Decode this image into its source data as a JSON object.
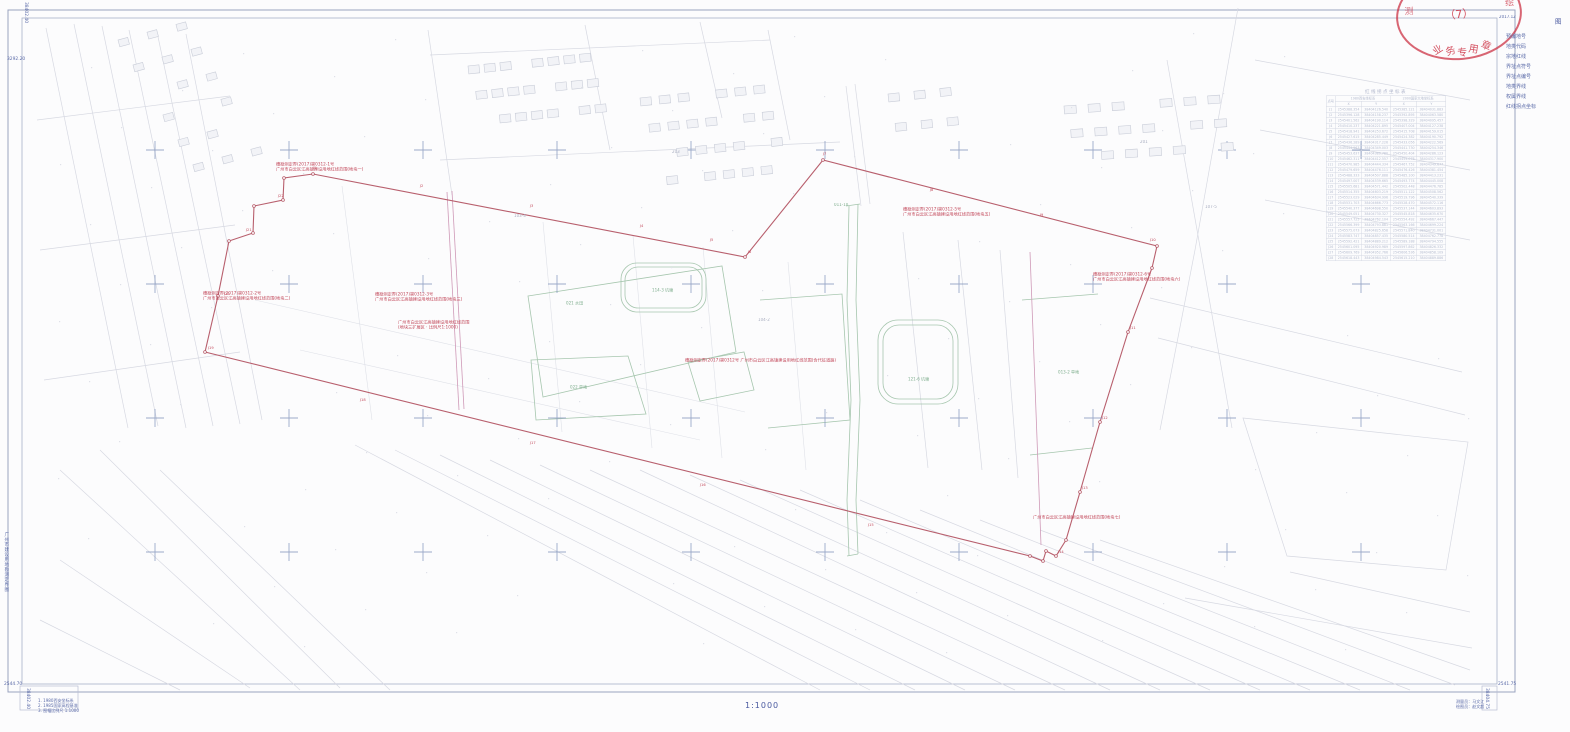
{
  "title_block": {
    "legend_title": "图  例",
    "side_title": "广州市建设用地勘测定界图",
    "scale_label": "1:1000",
    "date_label": "2017.12"
  },
  "stamp": {
    "center": "（7）",
    "arc": "业务专用章",
    "left_mark": "测",
    "right_mark": "绘"
  },
  "legend_items": [
    {
      "label": "预编地号",
      "sym": "text",
      "text": "1"
    },
    {
      "label": "地类代码",
      "sym": "text",
      "text": "221"
    },
    {
      "label": "宗地红线",
      "sym": "redline",
      "text": ""
    },
    {
      "label": "界址点符号",
      "sym": "circle",
      "text": ""
    },
    {
      "label": "界址点编号",
      "sym": "redtext",
      "text": "J1"
    },
    {
      "label": "地类界线",
      "sym": "grayline",
      "text": ""
    },
    {
      "label": "权属界线",
      "sym": "grayline2",
      "text": ""
    },
    {
      "label": "红线拐点坐标",
      "sym": "redtext",
      "text": "见表"
    }
  ],
  "coord_table": {
    "title": "红线拐点坐标表",
    "point_col": "点号",
    "sys1": "1980西安坐标系",
    "sys2": "2000国家大地坐标系",
    "x_col": "X",
    "y_col": "Y",
    "rows": [
      [
        "J1",
        "2545388.354",
        "38404126.540",
        "2545385.121",
        "38404031.883"
      ],
      [
        "J2",
        "2545396.128",
        "38404158.237",
        "2545392.895",
        "38404063.580"
      ],
      [
        "J3",
        "2545401.562",
        "38404190.114",
        "2545398.329",
        "38404095.457"
      ],
      [
        "J4",
        "2545410.237",
        "38404221.895",
        "2545407.004",
        "38404127.238"
      ],
      [
        "J5",
        "2545418.941",
        "38404253.672",
        "2545415.708",
        "38404159.015"
      ],
      [
        "J6",
        "2545427.615",
        "38404285.449",
        "2545424.382",
        "38404190.792"
      ],
      [
        "J7",
        "2545436.289",
        "38404317.226",
        "2545433.056",
        "38404222.569"
      ],
      [
        "J8",
        "2545444.963",
        "38404349.003",
        "2545441.730",
        "38404254.346"
      ],
      [
        "J9",
        "2545453.637",
        "38404380.780",
        "2545450.404",
        "38404286.123"
      ],
      [
        "J10",
        "2545462.311",
        "38404412.557",
        "2545459.078",
        "38404317.900"
      ],
      [
        "J11",
        "2545470.985",
        "38404444.334",
        "2545467.752",
        "38404349.677"
      ],
      [
        "J12",
        "2545479.659",
        "38404476.111",
        "2545476.426",
        "38404381.454"
      ],
      [
        "J13",
        "2545488.333",
        "38404507.888",
        "2545485.100",
        "38404413.231"
      ],
      [
        "J14",
        "2545497.007",
        "38404539.665",
        "2545493.774",
        "38404445.008"
      ],
      [
        "J15",
        "2545505.681",
        "38404571.442",
        "2545502.448",
        "38404476.785"
      ],
      [
        "J16",
        "2545514.355",
        "38404603.219",
        "2545511.122",
        "38404508.562"
      ],
      [
        "J17",
        "2545523.029",
        "38404634.996",
        "2545519.796",
        "38404540.339"
      ],
      [
        "J18",
        "2545531.703",
        "38404666.773",
        "2545528.470",
        "38404572.116"
      ],
      [
        "J19",
        "2545540.377",
        "38404698.550",
        "2545537.144",
        "38404603.893"
      ],
      [
        "J20",
        "2545549.051",
        "38404730.327",
        "2545545.818",
        "38404635.670"
      ],
      [
        "J21",
        "2545557.725",
        "38404762.104",
        "2545554.492",
        "38404667.447"
      ],
      [
        "J22",
        "2545566.399",
        "38404793.881",
        "2545563.166",
        "38404699.224"
      ],
      [
        "J23",
        "2545575.073",
        "38404825.658",
        "2545571.840",
        "38404731.001"
      ],
      [
        "J24",
        "2545583.747",
        "38404857.435",
        "2545580.514",
        "38404762.778"
      ],
      [
        "J25",
        "2545592.421",
        "38404889.212",
        "2545589.188",
        "38404794.555"
      ],
      [
        "J26",
        "2545601.095",
        "38404920.989",
        "2545597.862",
        "38404826.332"
      ],
      [
        "J27",
        "2545609.769",
        "38404952.766",
        "2545606.536",
        "38404858.109"
      ],
      [
        "J28",
        "2545618.443",
        "38404984.543",
        "2545615.210",
        "38404889.886"
      ]
    ]
  },
  "corner_labels": {
    "top_left_h": "3292.20",
    "top_left_v": "38402.40",
    "bottom_left_h": "2544.70",
    "bottom_left_v": "38402.40",
    "bottom_right_h": "2541.75",
    "bottom_right_v": "38404.75"
  },
  "notes": [
    "1. 1980西安坐标系",
    "2. 1985国家高程基准",
    "3. 图幅比例尺 1:1000"
  ],
  "credits": [
    "测量员：马文江",
    "绘图员：赵文超"
  ],
  "annotations": [
    {
      "x": 276,
      "y": 162,
      "lines": [
        "穗勘测定界(2017)第0312-1号",
        "广州市白云区江高镇建设用地红线范围(地块一)"
      ]
    },
    {
      "x": 203,
      "y": 291,
      "lines": [
        "穗勘测定界(2017)第0312-2号",
        "广州市白云区江高镇建设用地红线范围(地块二)"
      ]
    },
    {
      "x": 375,
      "y": 292,
      "lines": [
        "穗勘测定界(2017)第0312-3号",
        "广州市白云区江高镇建设用地红线范围(地块三)"
      ]
    },
    {
      "x": 398,
      "y": 320,
      "lines": [
        "广州市白云区江高镇建设用地红线范围",
        "(地块三扩展区 · 比例尺1:1000)"
      ]
    },
    {
      "x": 685,
      "y": 358,
      "lines": [
        "穗勘测定界(2017)第0312号 广州市白云区江高镇建设用地红线范围(含代征道路)"
      ]
    },
    {
      "x": 903,
      "y": 207,
      "lines": [
        "穗勘测定界(2017)第0312-5号",
        "广州市白云区江高镇建设用地红线范围(地块五)"
      ]
    },
    {
      "x": 1093,
      "y": 272,
      "lines": [
        "穗勘测定界(2017)第0312-6号",
        "广州市白云区江高镇建设用地红线范围(地块六)"
      ]
    },
    {
      "x": 1033,
      "y": 515,
      "lines": [
        "广州市白云区江高镇建设用地红线范围(地块七)"
      ]
    }
  ],
  "area_labels": [
    {
      "x": 566,
      "y": 300,
      "t": "021 水田",
      "c": "green"
    },
    {
      "x": 570,
      "y": 384,
      "t": "022 旱地",
      "c": "green"
    },
    {
      "x": 652,
      "y": 287,
      "t": "114-3 坑塘",
      "c": "green"
    },
    {
      "x": 908,
      "y": 376,
      "t": "121-6 坑塘",
      "c": "green"
    },
    {
      "x": 834,
      "y": 203,
      "t": "011-10",
      "c": "green"
    },
    {
      "x": 1058,
      "y": 369,
      "t": "013-2 旱地",
      "c": "green"
    },
    {
      "x": 514,
      "y": 214,
      "t": "103-4",
      "c": "gray"
    },
    {
      "x": 758,
      "y": 318,
      "t": "104-2",
      "c": "gray"
    },
    {
      "x": 1205,
      "y": 205,
      "t": "107-5",
      "c": "gray"
    },
    {
      "x": 672,
      "y": 150,
      "t": "203",
      "c": "gray"
    },
    {
      "x": 1140,
      "y": 140,
      "t": "201",
      "c": "gray"
    }
  ],
  "vertex_labels": [
    {
      "x": 313,
      "y": 166,
      "t": "J1"
    },
    {
      "x": 420,
      "y": 184,
      "t": "J2"
    },
    {
      "x": 530,
      "y": 204,
      "t": "J3"
    },
    {
      "x": 640,
      "y": 224,
      "t": "J4"
    },
    {
      "x": 710,
      "y": 238,
      "t": "J5"
    },
    {
      "x": 748,
      "y": 250,
      "t": "J6"
    },
    {
      "x": 823,
      "y": 152,
      "t": "J7"
    },
    {
      "x": 930,
      "y": 188,
      "t": "J8"
    },
    {
      "x": 1040,
      "y": 213,
      "t": "J9"
    },
    {
      "x": 1150,
      "y": 238,
      "t": "J10"
    },
    {
      "x": 1130,
      "y": 326,
      "t": "J11"
    },
    {
      "x": 1102,
      "y": 416,
      "t": "J12"
    },
    {
      "x": 1082,
      "y": 486,
      "t": "J13"
    },
    {
      "x": 1058,
      "y": 550,
      "t": "J14"
    },
    {
      "x": 868,
      "y": 523,
      "t": "J15"
    },
    {
      "x": 700,
      "y": 483,
      "t": "J16"
    },
    {
      "x": 530,
      "y": 441,
      "t": "J17"
    },
    {
      "x": 360,
      "y": 398,
      "t": "J18"
    },
    {
      "x": 208,
      "y": 346,
      "t": "J19"
    },
    {
      "x": 224,
      "y": 292,
      "t": "J20"
    },
    {
      "x": 246,
      "y": 228,
      "t": "J21"
    },
    {
      "x": 278,
      "y": 194,
      "t": "J22"
    }
  ]
}
